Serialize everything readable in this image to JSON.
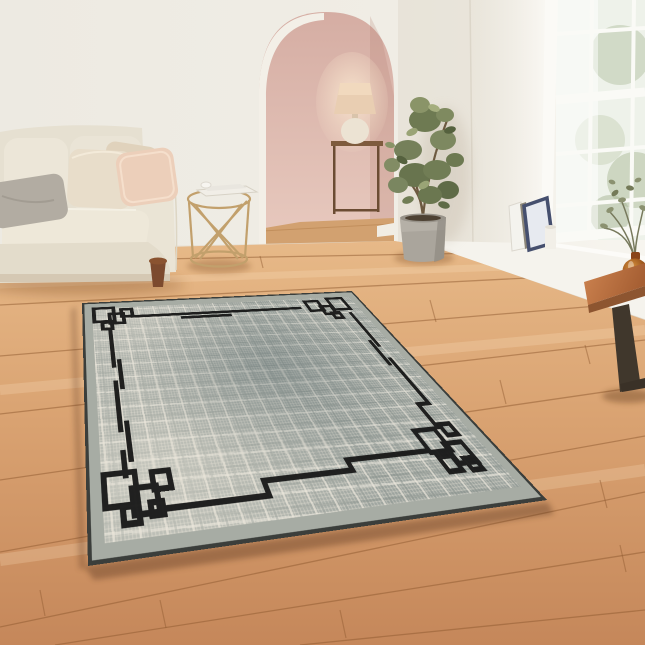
{
  "image": {
    "width": 645,
    "height": 645,
    "alt": "Bright living room with a grey crosshatch-textured area rug featuring a black geometric border, laid diagonally on a warm wooden plank floor"
  },
  "palette": {
    "wall_cream": "#efece4",
    "wall_greige": "#e5e0d8",
    "arch_pink": "#dcb5ab",
    "window_white": "#fbfaf6",
    "floor_wood": "#d9a271",
    "floor_seam": "#8f5a30",
    "sofa_cream": "#e9e3d4",
    "cushion_grey": "#b2aca2",
    "cushion_blush": "#eccfba",
    "brass": "#c2a06c",
    "plant_green": "#6e7a52",
    "pot_grey": "#aaa59c",
    "bench_wood": "#b06a3e",
    "bench_leg": "#40372c",
    "vase_amber": "#a05a1e",
    "rug_field": "#9da49f",
    "rug_texture_cream": "#e9e4d8",
    "rug_texture_grey": "#8f9793",
    "rug_border_black": "#161616",
    "rug_margin": "#a7aca4",
    "rug_binding": "#3b3e3b"
  },
  "scene": {
    "room_label": "living room product photo",
    "wall": {
      "label": "cream plaster wall"
    },
    "archway": {
      "label": "arched doorway to pink hallway",
      "items": [
        "console table",
        "table lamp with beige shade",
        "round cream vase",
        "wooden hallway floor"
      ]
    },
    "window": {
      "label": "white sash window with garden view",
      "pane_columns": 3,
      "pane_rows": 4
    },
    "sill_items": {
      "label": "leaning picture frames, books and candle on window ledge"
    },
    "sofa": {
      "label": "cream two-seat sofa with rolled arm",
      "cushions": [
        "grey velvet cushion",
        "beige linen cushion",
        "blush pink cushion"
      ]
    },
    "side_table": {
      "label": "round brass wire side table",
      "items": [
        "magazines",
        "small white cup"
      ]
    },
    "plant": {
      "label": "potted ficus plant in grey concrete pot"
    },
    "bench": {
      "label": "wooden bench with angular dark metal leg",
      "items": [
        "amber glass vase",
        "dried green stems",
        "stack of white books"
      ]
    },
    "floor": {
      "label": "diagonal wooden plank flooring"
    },
    "rug": {
      "label": "grey textured area rug with black geometric interlocking-square border",
      "style": "art-deco / Greek key corner motifs",
      "field": "mottled grey-green crosshatch weave with cream slubs",
      "border": "thin black frame with stepped jogs and overlapping square clusters at each corner"
    }
  }
}
